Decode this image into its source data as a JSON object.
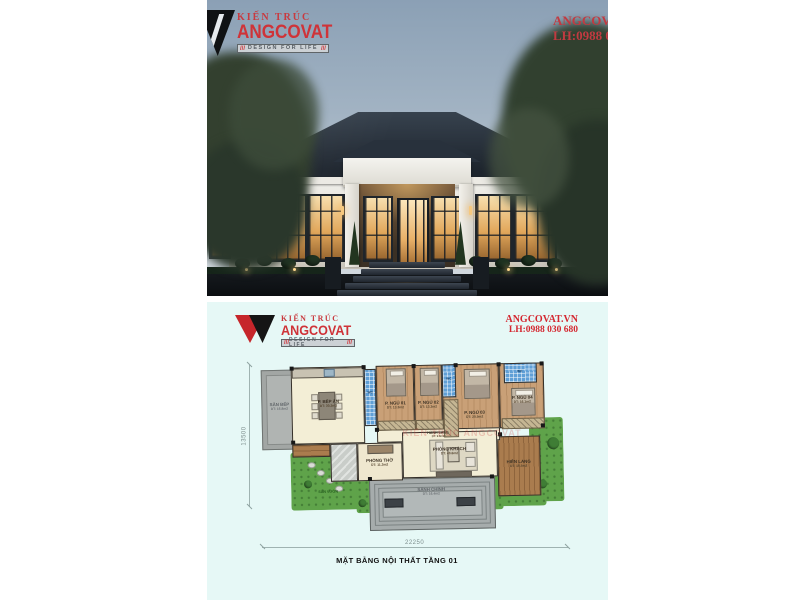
{
  "brand": {
    "kien_truc": "KIẾN TRÚC",
    "name": "ANGCOVAT",
    "tagline": "DESIGN FOR LIFE",
    "slashes": "///",
    "site": "ANGCOVAT.VN",
    "phone": "LH:0988 030 680",
    "red": "#c6262b"
  },
  "plan": {
    "title": "MẶT BẰNG NỘI THẤT TẦNG 01",
    "dim_width": "22250",
    "dim_height": "13500",
    "watermark": "KIẾN TRÚC ANGCOVAT",
    "rooms": {
      "terrace": {
        "name": "SÂN BẾP",
        "area": "DT: 16.8m2"
      },
      "kitchen": {
        "name": "P. BẾP ĂN",
        "area": "DT: 30.2m2"
      },
      "bed1": {
        "name": "P. NGỦ 01",
        "area": "DT: 13.3m2"
      },
      "bed2": {
        "name": "P. NGỦ 02",
        "area": "DT: 13.3m2"
      },
      "bed3": {
        "name": "P. NGỦ 03",
        "area": "DT: 20.5m2"
      },
      "bed4": {
        "name": "P. NGỦ 04",
        "area": "DT: 16.1m2"
      },
      "wc": {
        "name": "WC"
      },
      "hallway": {
        "name": "HÀNH LANG",
        "area": "DT: 9.8m2"
      },
      "worship": {
        "name": "PHÒNG THỜ",
        "area": "DT: 11.3m2"
      },
      "living": {
        "name": "PHÒNG KHÁCH",
        "area": "DT: 40.6m2"
      },
      "porch": {
        "name": "SẢNH CHÍNH",
        "area": "DT: 16.4m2"
      },
      "deck": {
        "name": "HIÊN LANG",
        "area": "DT: 10.5m2"
      },
      "garden": {
        "name": "SÂN VƯỜN"
      }
    }
  }
}
